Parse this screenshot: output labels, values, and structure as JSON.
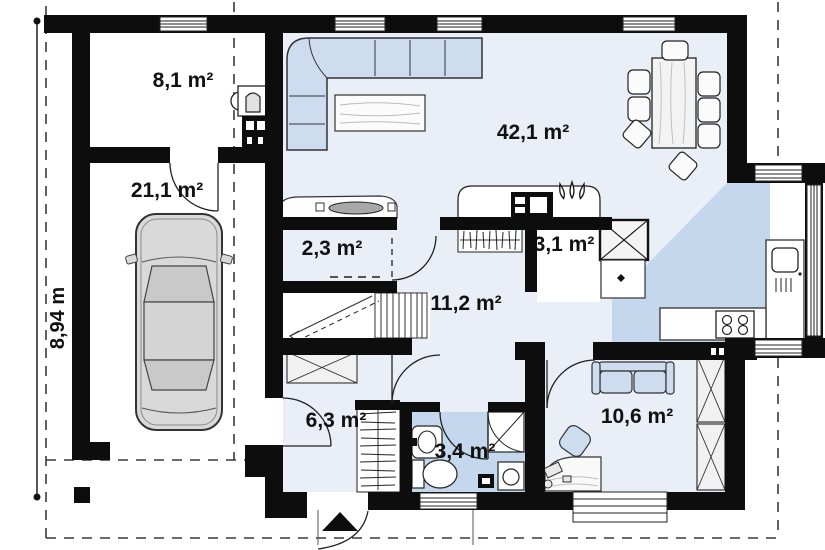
{
  "title": "House ground floor plan",
  "dimension": {
    "left_height": "8,94 m"
  },
  "rooms": [
    {
      "id": "storage",
      "label": "8,1 m²"
    },
    {
      "id": "garage",
      "label": "21,1 m²"
    },
    {
      "id": "living",
      "label": "42,1 m²"
    },
    {
      "id": "pantry",
      "label": "2,3 m²"
    },
    {
      "id": "closet",
      "label": "3,1 m²"
    },
    {
      "id": "hall",
      "label": "11,2 m²"
    },
    {
      "id": "vestibule",
      "label": "6,3 m²"
    },
    {
      "id": "bathroom",
      "label": "3,4 m²"
    },
    {
      "id": "office",
      "label": "10,6 m²"
    }
  ],
  "colors": {
    "wall": "#0d0d0d",
    "floor_light": "#e9eef7",
    "floor_accent": "#c4d7ec",
    "furniture_blue": "#cddcef",
    "car_grey": "#d9d9d9"
  }
}
